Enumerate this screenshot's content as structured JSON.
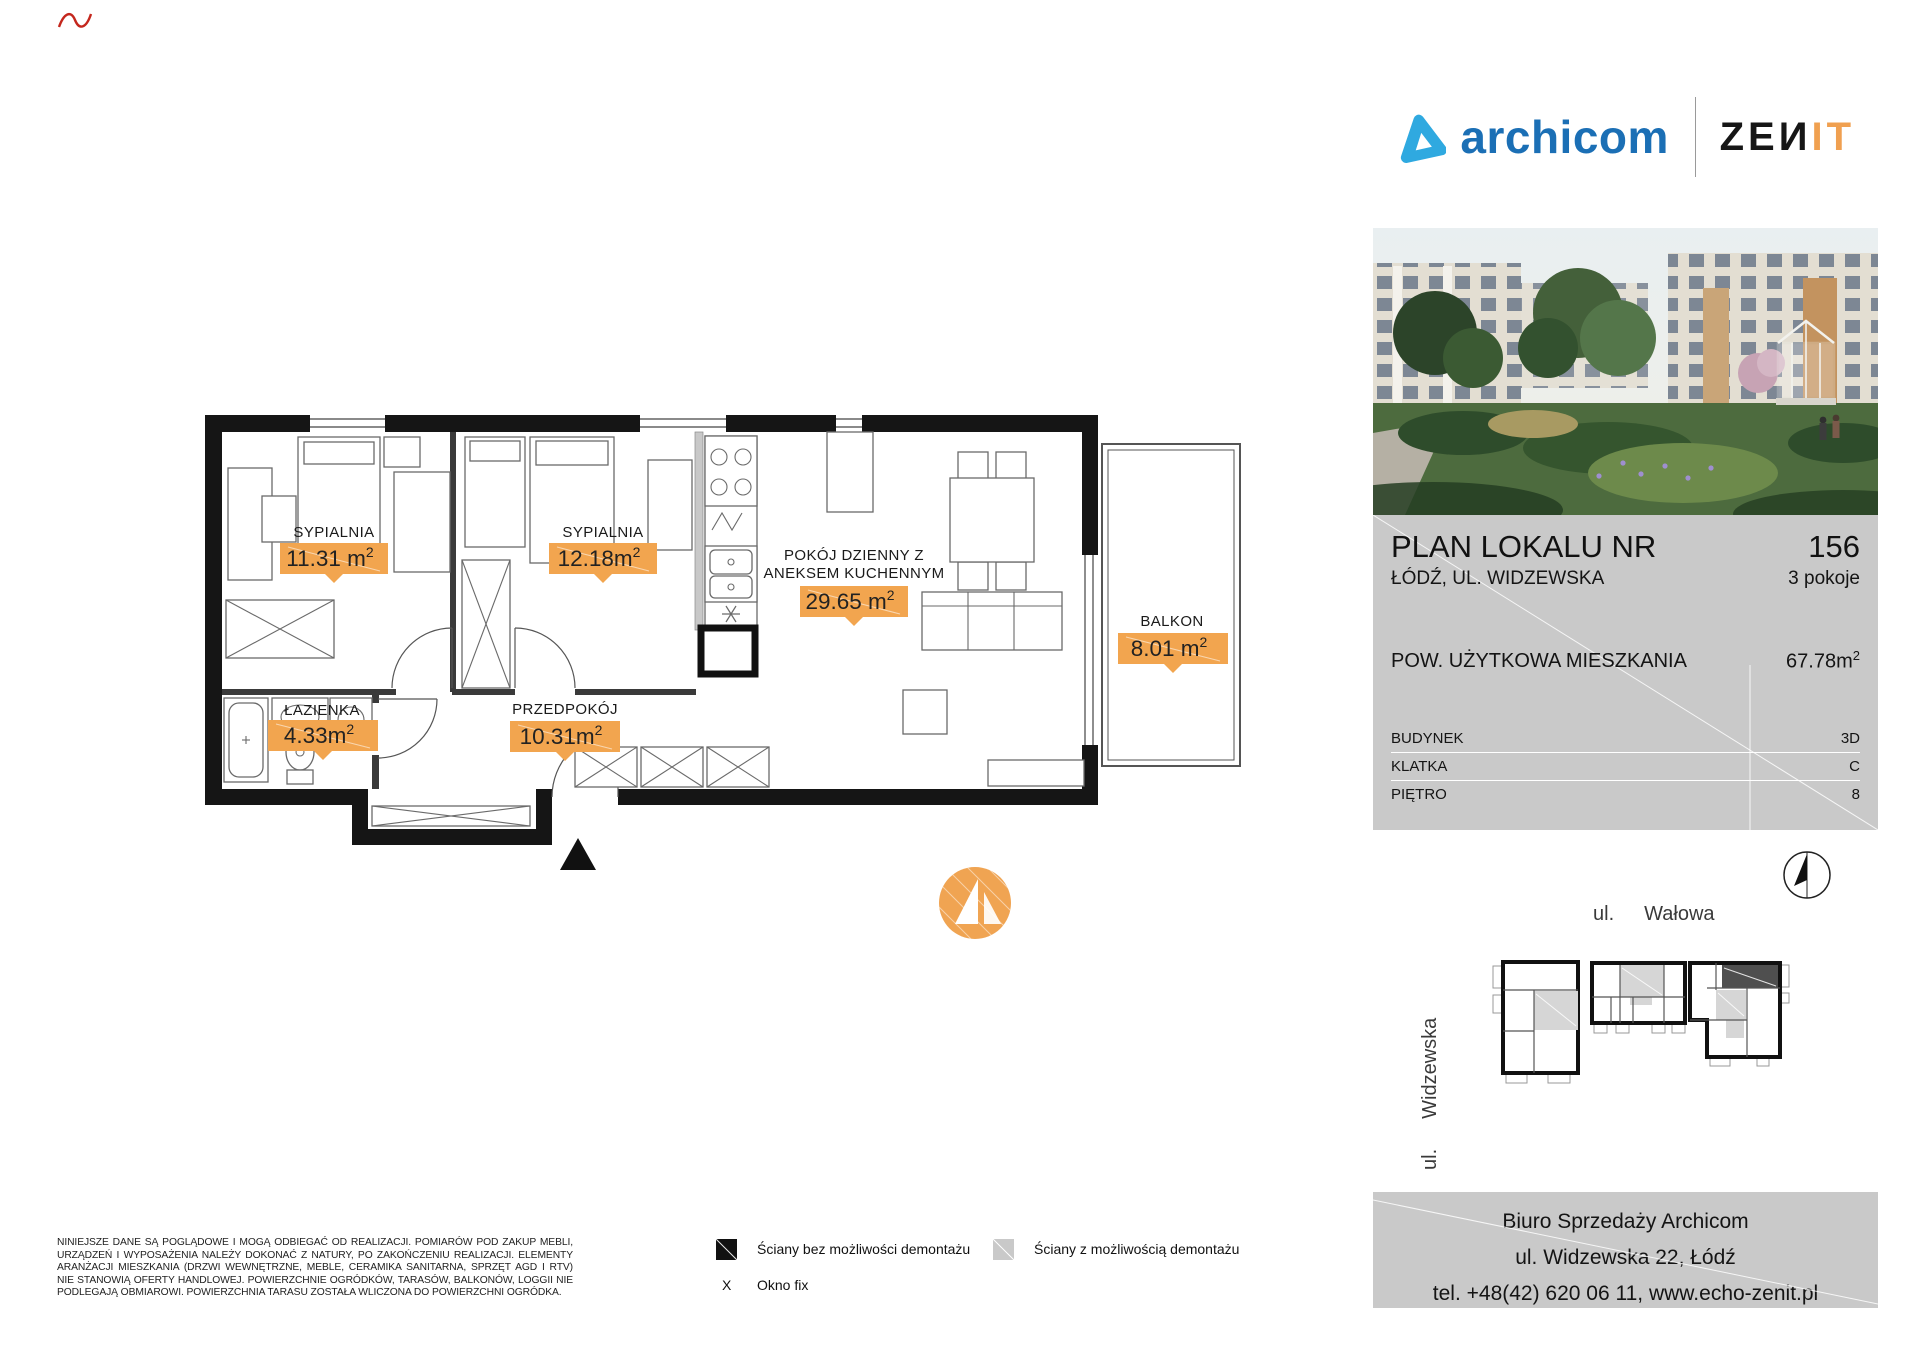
{
  "header": {
    "archicom_text": "archicom",
    "zenit_dark": "ZEИ",
    "zenit_orange": "IT"
  },
  "colors": {
    "archicom_blue": "#1b6fb5",
    "archicom_light_blue": "#2fa9e0",
    "zenit_orange": "#f0a050",
    "badge_orange": "#f2a54f",
    "panel_gray": "#c9c9c9",
    "highlight_unit_dark": "#4f4f4f"
  },
  "info_panel": {
    "title": "PLAN LOKALU NR",
    "unit_number": "156",
    "address": "ŁÓDŹ, UL. WIDZEWSKA",
    "rooms_count": "3 pokoje",
    "area_label": "POW. UŻYTKOWA MIESZKANIA",
    "area_value": "67.78m",
    "area_sup": "2",
    "details": [
      {
        "label": "BUDYNEK",
        "value": "3D"
      },
      {
        "label": "KLATKA",
        "value": "C"
      },
      {
        "label": "PIĘTRO",
        "value": "8"
      }
    ]
  },
  "floor_plan": {
    "rooms": [
      {
        "name": "SYPIALNIA",
        "area": "11.31 m",
        "sup": "2"
      },
      {
        "name": "SYPIALNIA",
        "area": "12.18m",
        "sup": "2"
      },
      {
        "name_line1": "POKÓJ DZIENNY Z",
        "name_line2": "ANEKSEM KUCHENNYM",
        "area": "29.65 m",
        "sup": "2"
      },
      {
        "name": "BALKON",
        "area": "8.01 m",
        "sup": "2"
      },
      {
        "name": "ŁAZIENKA",
        "area": "4.33m",
        "sup": "2"
      },
      {
        "name": "PRZEDPOKÓJ",
        "area": "10.31m",
        "sup": "2"
      }
    ]
  },
  "site_map": {
    "street_top_prefix": "ul.",
    "street_top_name": "Wałowa",
    "street_left_prefix": "ul.",
    "street_left_name": "Widzewska"
  },
  "legend": {
    "wall_solid_label": "Ściany bez możliwości demontażu",
    "wall_removable_label": "Ściany z możliwością demontażu",
    "window_symbol": "X",
    "window_label": "Okno fix"
  },
  "disclaimer_lines": [
    "NINIEJSZE DANE SĄ POGLĄDOWE I MOGĄ ODBIEGAĆ OD REALIZACJI. POMIARÓW POD ZAKUP MEBLI,",
    "URZĄDZEŃ I WYPOSAŻENIA NALEŻY DOKONAĆ Z NATURY, PO ZAKOŃCZENIU REALIZACJI. ELEMENTY",
    "ARANŻACJI MIESZKANIA (DRZWI WEWNĘTRZNE, MEBLE, CERAMIKA SANITARNA, SPRZĘT AGD I RTV)",
    "NIE STANOWIĄ OFERTY HANDLOWEJ. POWIERZCHNIE OGRÓDKÓW, TARASÓW, BALKONÓW, LOGGII NIE",
    "PODLEGAJĄ OBMIAROWI. POWIERZCHNIA TARASU ZOSTAŁA WLICZONA DO POWIERZCHNI OGRÓDKA."
  ],
  "contact_box": {
    "line1": "Biuro Sprzedaży Archicom",
    "line2": "ul. Widzewska 22, Łódź",
    "line3": "tel. +48(42) 620 06 11, www.echo-zenit.pl"
  }
}
